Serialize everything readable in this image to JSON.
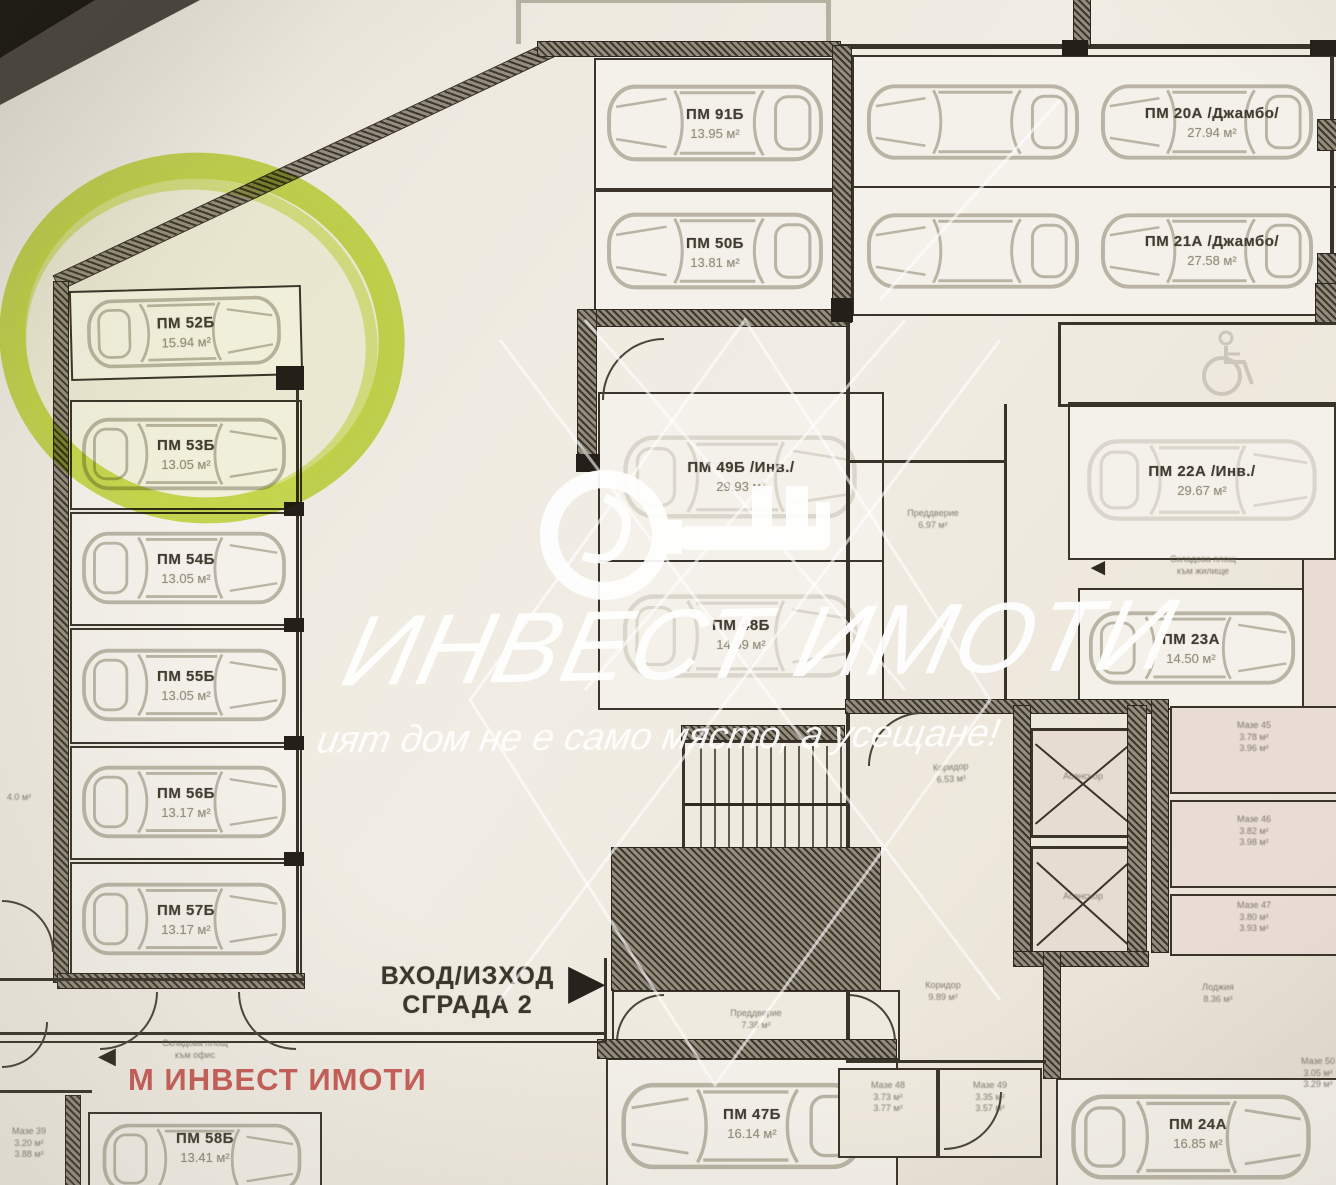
{
  "agency": {
    "name_red": "М ИНВЕСТ ИМОТИ",
    "watermark_script": "ИНВЕСТ ИМОТИ",
    "slogan": "ият дом не е само място, а усещане!"
  },
  "entrance": {
    "line1": "ВХОД/ИЗХОД",
    "line2": "СГРАДА 2"
  },
  "icons": {
    "arrow_right": "►",
    "arrow_left": "◄"
  },
  "colors": {
    "highlight_green": "#c3dc3a",
    "agency_red": "#c4514d",
    "ink": "#35302a",
    "paper": "#ece8df"
  },
  "stalls": {
    "s52": {
      "id": "ПМ 52Б",
      "area": "15.94 м²"
    },
    "s53": {
      "id": "ПМ 53Б",
      "area": "13.05 м²"
    },
    "s54": {
      "id": "ПМ 54Б",
      "area": "13.05 м²"
    },
    "s55": {
      "id": "ПМ 55Б",
      "area": "13.05 м²"
    },
    "s56": {
      "id": "ПМ 56Б",
      "area": "13.17 м²"
    },
    "s57": {
      "id": "ПМ 57Б",
      "area": "13.17 м²"
    },
    "s58": {
      "id": "ПМ 58Б",
      "area": "13.41 м²"
    },
    "s91": {
      "id": "ПМ 91Б",
      "area": "13.95 м²"
    },
    "s50": {
      "id": "ПМ 50Б",
      "area": "13.81 м²"
    },
    "s20": {
      "id": "ПМ 20А /Джамбо/",
      "area": "27.94 м²"
    },
    "s21": {
      "id": "ПМ 21А /Джамбо/",
      "area": "27.58 м²"
    },
    "s49": {
      "id": "ПМ 49Б /Инв./",
      "area": "29.93 м²"
    },
    "s48": {
      "id": "ПМ 48Б",
      "area": "14.59 м²"
    },
    "s47": {
      "id": "ПМ 47Б",
      "area": "16.14 м²"
    },
    "s22": {
      "id": "ПМ 22А /Инв./",
      "area": "29.67 м²"
    },
    "s23": {
      "id": "ПМ 23А",
      "area": "14.50 м²"
    },
    "s24": {
      "id": "ПМ 24А",
      "area": "16.85 м²"
    }
  },
  "rooms": {
    "vestibule_core": {
      "name": "Преддверие",
      "area": "6.97 м²"
    },
    "corridor_core": {
      "name": "Коридор",
      "area": "6.53 м²"
    },
    "corridor_south": {
      "name": "Коридор",
      "area": "9.89 м²"
    },
    "vestibule_south": {
      "name": "Преддверие",
      "area": "7.38 м²"
    },
    "elevator": "Асансьор",
    "note_right_1": "Складова площ",
    "note_right_2": "към жилище",
    "note_left_1": "Складова площ",
    "note_left_2": "към офис",
    "loggia_1": "Лоджия",
    "loggia_2": "8.36 м²"
  },
  "storage": {
    "mid": [
      {
        "l1": "Мазе 42",
        "l2": "3.11 м²",
        "l3": "3.53 м²"
      },
      {
        "l1": "Мазе 43",
        "l2": "3.07 м²",
        "l3": "3.56 м²"
      },
      {
        "l1": "Мазе 44",
        "l2": "3.15 м²",
        "l3": "3.66 м²"
      }
    ],
    "right": [
      {
        "l1": "Мазе 45",
        "l2": "3.78 м²",
        "l3": "3.96 м²"
      },
      {
        "l1": "Мазе 46",
        "l2": "3.82 м²",
        "l3": "3.98 м²"
      },
      {
        "l1": "Мазе 47",
        "l2": "3.80 м²",
        "l3": "3.93 м²"
      }
    ],
    "south": [
      {
        "l1": "Мазе 48",
        "l2": "3.73 м²",
        "l3": "3.77 м²"
      },
      {
        "l1": "Мазе 49",
        "l2": "3.35 м²",
        "l3": "3.57 м²"
      }
    ],
    "edge_left": {
      "l1": "Мазе 39",
      "l2": "3.20 м²",
      "l3": "3.88 м²"
    },
    "edge_right": {
      "l1": "Мазе 50",
      "l2": "3.05 м²",
      "l3": "3.29 м²"
    },
    "edge_note": "4.0 м²"
  }
}
